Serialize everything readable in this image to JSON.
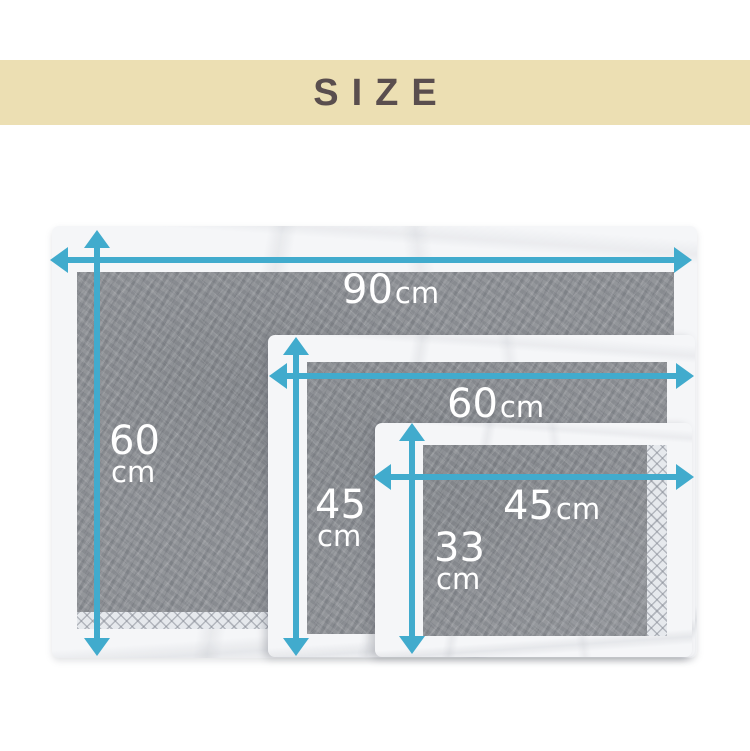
{
  "header": {
    "title": "SIZE"
  },
  "diagram": {
    "pads": [
      {
        "name": "large-pad",
        "width": {
          "value": "90",
          "unit": "cm"
        },
        "height": {
          "value": "60",
          "unit": "cm"
        }
      },
      {
        "name": "medium-pad",
        "width": {
          "value": "60",
          "unit": "cm"
        },
        "height": {
          "value": "45",
          "unit": "cm"
        }
      },
      {
        "name": "small-pad",
        "width": {
          "value": "45",
          "unit": "cm"
        },
        "height": {
          "value": "33",
          "unit": "cm"
        }
      }
    ]
  },
  "colors": {
    "banner_bg": "#ecdfb3",
    "title_text": "#5a4e4e",
    "arrow": "#41abcd",
    "dimension_text": "#ffffff",
    "pad_fabric": "#f5f6f8",
    "pad_charcoal": "#8d9095"
  }
}
